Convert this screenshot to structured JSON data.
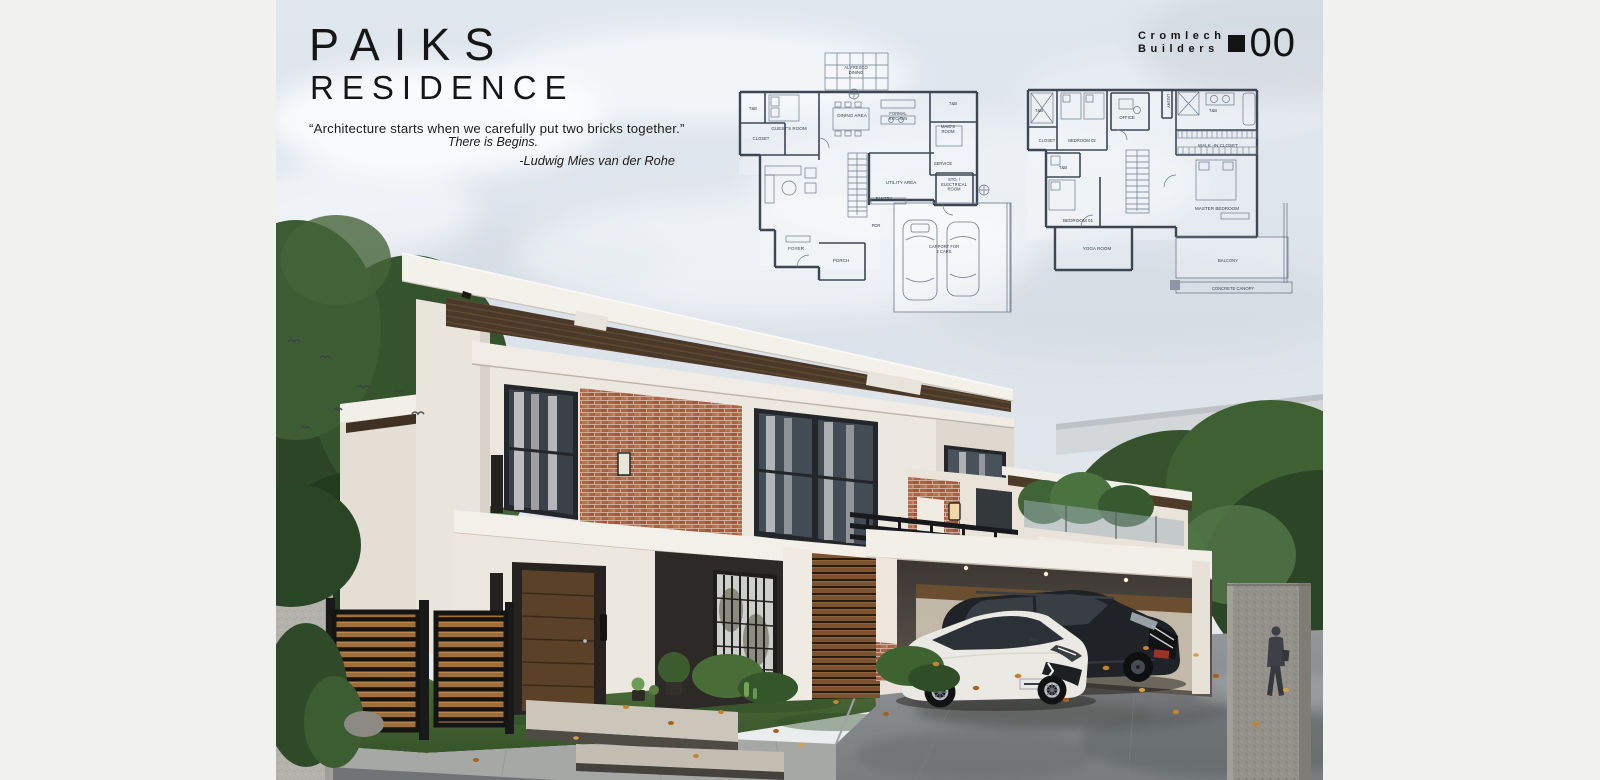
{
  "board": {
    "title_line1": "PAIKS",
    "title_line2": "RESIDENCE",
    "quote": {
      "line1": "“Architecture starts when we carefully put two bricks together.”",
      "line2": "There is Begins.",
      "attribution": "-Ludwig Mies van der Rohe"
    },
    "logo": {
      "name_line1": "Cromlech",
      "name_line2": "Builders",
      "sheet_number": "00"
    }
  },
  "floor_plans": {
    "ground_floor": {
      "labels": [
        "AL FRESCO\nDINING",
        "T&B",
        "GUEST'S ROOM",
        "CLOSET",
        "DINING AREA",
        "FORMAL\nKITCHEN",
        "T&B",
        "MAID'S\nROOM",
        "SERVICE",
        "UTILITY AREA",
        "STO. /\nELECTRICAL\nROOM",
        "PANTRY",
        "PDR",
        "FOYER",
        "PORCH",
        "CARPORT FOR\n2 CARS"
      ]
    },
    "second_floor": {
      "labels": [
        "T&B",
        "CLOSET",
        "BEDROOM 02",
        "OFFICE",
        "LNDRY",
        "T&B",
        "WALK -IN CLOSET",
        "T&B",
        "BEDROOM 01",
        "MASTER BEDROOM",
        "YOGA ROOM",
        "BALCONY",
        "CONCRETE CANOPY"
      ]
    }
  },
  "palette": {
    "page_background": "#f1f1ef",
    "sky": "#e3e9f0",
    "plan_line": "#3d4754",
    "wall_cream": "#ece7df",
    "brick": "#b5684a",
    "wood_slat": "#7c5230",
    "charcoal_wall": "#2c2927",
    "roof_white": "#f4f1eb",
    "soffit_wood": "#4a3828",
    "grass": "#4c6c39",
    "driveway": "#8b8e90",
    "suv_black": "#1f2226",
    "sedan_white": "#ebe9e3",
    "leaf_orange": "#c28432"
  }
}
